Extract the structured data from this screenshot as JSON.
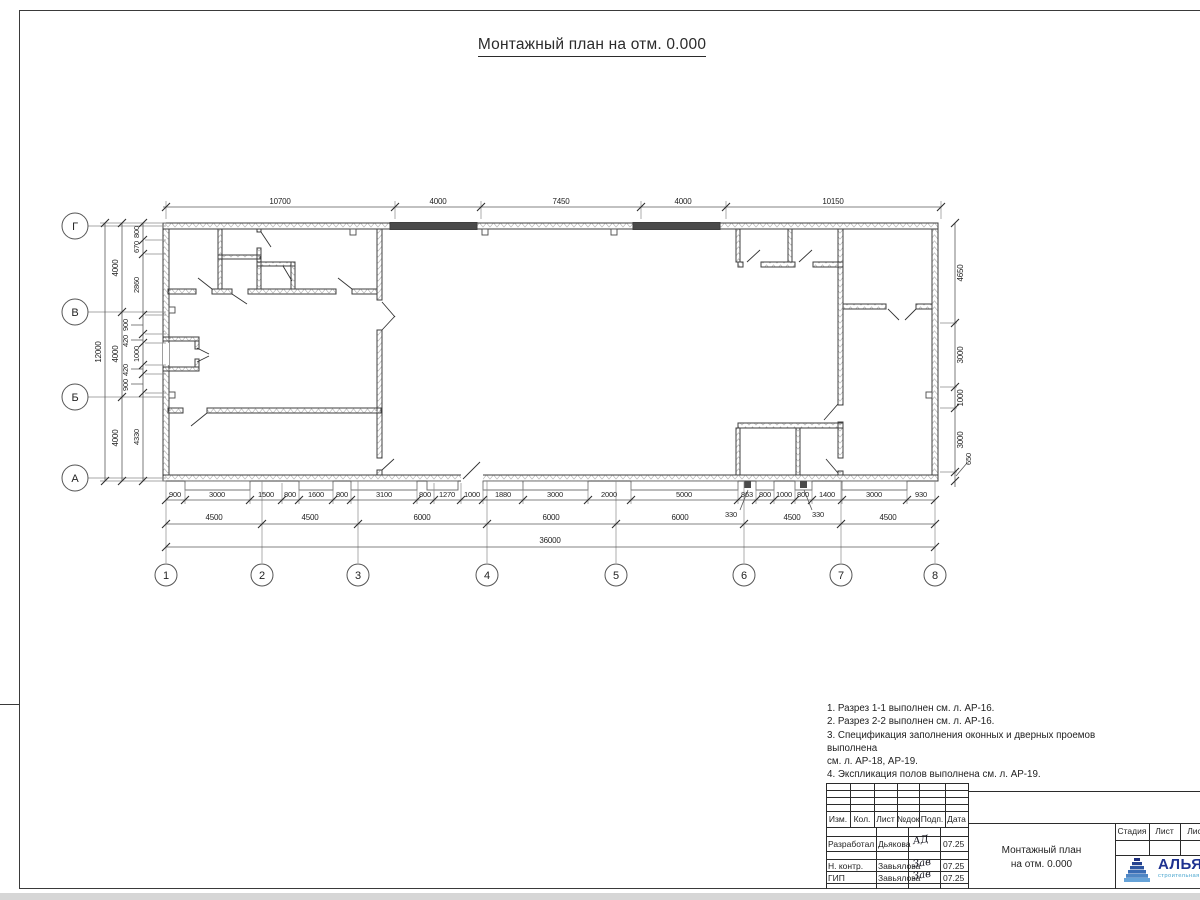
{
  "sheet": {
    "title": "Монтажный план на отм. 0.000"
  },
  "plan": {
    "row_axes": [
      "Г",
      "В",
      "Б",
      "А"
    ],
    "col_axes": [
      "1",
      "2",
      "3",
      "4",
      "5",
      "6",
      "7",
      "8"
    ],
    "top_dims": [
      "10700",
      "4000",
      "7450",
      "4000",
      "10150"
    ],
    "left_total": "12000",
    "left_bays": [
      "4000",
      "4000",
      "4000"
    ],
    "left_chain": [
      "800",
      "670",
      "2860",
      "900",
      "420",
      "1000",
      "420",
      "900",
      "4330"
    ],
    "right_chain": [
      "4650",
      "3000",
      "1000",
      "3000",
      "650"
    ],
    "bottom_chain": [
      "900",
      "3000",
      "1500",
      "800",
      "1600",
      "800",
      "3100",
      "800",
      "1270",
      "1000",
      "1880",
      "3000",
      "2000",
      "5000",
      "863",
      "800",
      "1000",
      "800",
      "1400",
      "3000",
      "930"
    ],
    "bottom_leaders": [
      "330",
      "330"
    ],
    "bottom_spans": [
      "4500",
      "4500",
      "6000",
      "6000",
      "6000",
      "4500",
      "4500"
    ],
    "bottom_total": "36000"
  },
  "notes": {
    "lines": [
      "1. Разрез 1-1 выполнен см. л. АР-16.",
      "2. Разрез 2-2 выполнен см. л. АР-16.",
      "3. Спецификация заполнения оконных и дверных проемов выполнена",
      "см. л. АР-18, АР-19.",
      "4. Экспликация полов выполнена см. л. АР-19."
    ]
  },
  "titleblock": {
    "header_cells": [
      "Изм.",
      "Кол.",
      "Лист",
      "№док",
      "Подп.",
      "Дата"
    ],
    "rows": [
      {
        "role": "Разработал",
        "name": "Дьякова",
        "sign": "АД",
        "date": "07.25"
      },
      {
        "role": "Н. контр.",
        "name": "Завьялова",
        "sign": "Зав",
        "date": "07.25"
      },
      {
        "role": "ГИП",
        "name": "Завьялова",
        "sign": "Зав",
        "date": "07.25"
      }
    ],
    "doc_title_line1": "Монтажный план",
    "doc_title_line2": "на отм. 0.000",
    "stage_cells": [
      "Стадия",
      "Лист",
      "Листов"
    ],
    "logo": {
      "text": "АЛЬЯНС",
      "subtitle": "строительная компания",
      "accent": "#1d3190",
      "accent2": "#4aa6cf"
    }
  }
}
